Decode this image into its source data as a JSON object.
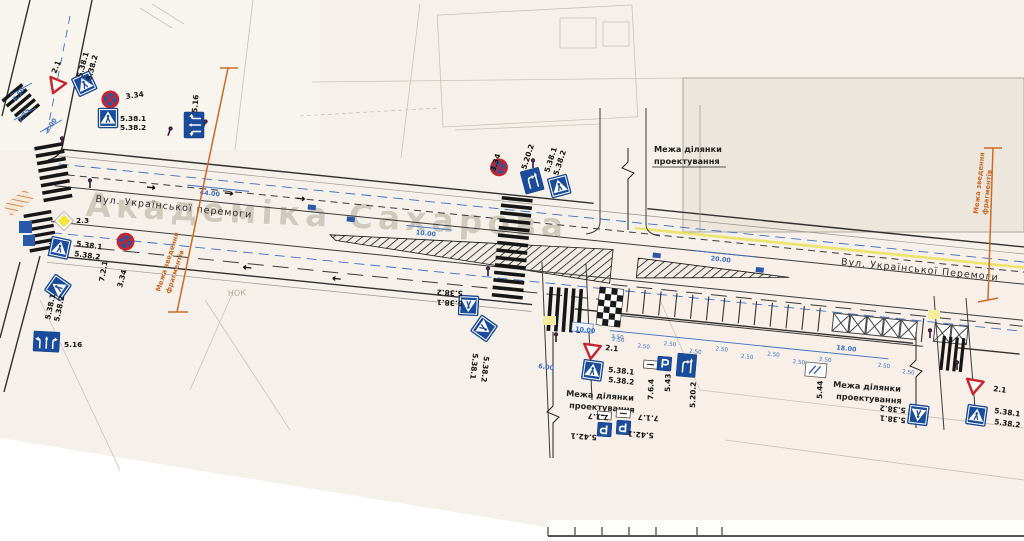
{
  "signs": {
    "pedestrian_crossing_1": "5.38.1",
    "pedestrian_crossing_2": "5.38.2",
    "no_stopping": "3.34",
    "give_way": "2.1",
    "priority_road": "2.3",
    "lane_directions": "5.16",
    "lane_start": "5.20.2",
    "parking_zone": "5.42.1",
    "parking": "5.43",
    "parking_end": "5.44",
    "plate_717": "7.1.7",
    "plate_721": "7.2.1",
    "plate_764": "7.6.4"
  },
  "texts": {
    "design_area_line1": "Межа ділянки",
    "design_area_line2": "проектування",
    "fragment_line1": "Межа зведення",
    "fragment_line2": "фрагментів",
    "street_basemap": "Академіка Сахарова",
    "street_main_left": "Вул. Української перемоги",
    "street_main_right": "Вул. Української Перемоги",
    "basemap_nok": "НОК"
  },
  "dimensions": {
    "d650": "6.50",
    "d275": "2.75",
    "d300": "3.00",
    "d4400": "44.00",
    "d1000": "10.00",
    "d2000": "20.00",
    "d600": "6.00",
    "d1800": "18.00",
    "d250": "2.50",
    "d350": "3.50"
  },
  "colors": {
    "sign_blue": "#1a4c9c",
    "sign_red": "#c8242b",
    "boundary_orange": "#cf6a28",
    "dim_blue": "#3b6fc4",
    "marking_yellow": "#e8e24a",
    "paper": "#f5f0e9"
  }
}
